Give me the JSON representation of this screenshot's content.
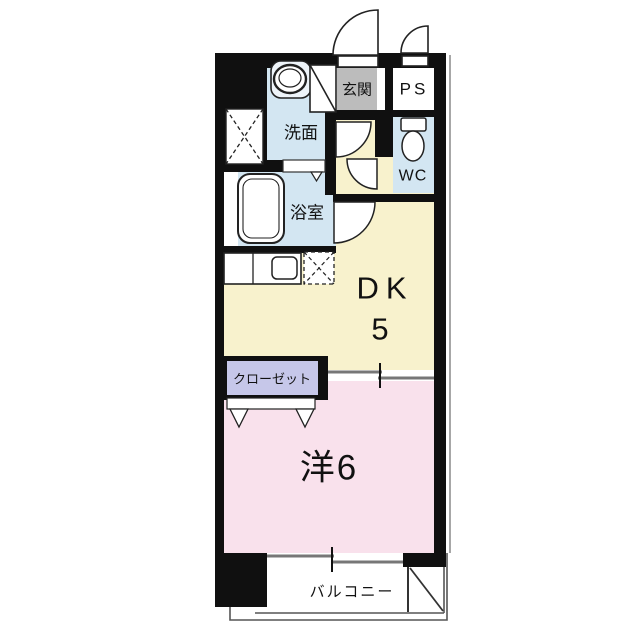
{
  "floorplan": {
    "title": "1DK apartment floor plan",
    "rooms": {
      "entrance": {
        "label": "玄関"
      },
      "pipe_space": {
        "label": "PS"
      },
      "washroom": {
        "label": "洗面"
      },
      "toilet": {
        "label": "WC"
      },
      "bathroom": {
        "label": "浴室"
      },
      "dining_kitchen": {
        "label": "DK",
        "size_tatami": "5"
      },
      "closet": {
        "label": "クローゼット"
      },
      "western_room": {
        "label": "洋6"
      },
      "balcony": {
        "label": "バルコニー"
      }
    },
    "colors": {
      "wall": "#101010",
      "cream": "#f8f2cd",
      "pink": "#f9e1ec",
      "blue": "#d3e6f2",
      "gray": "#bcbcbc",
      "lavender": "#c6c7e9",
      "white": "#ffffff",
      "line": "#777777"
    }
  }
}
